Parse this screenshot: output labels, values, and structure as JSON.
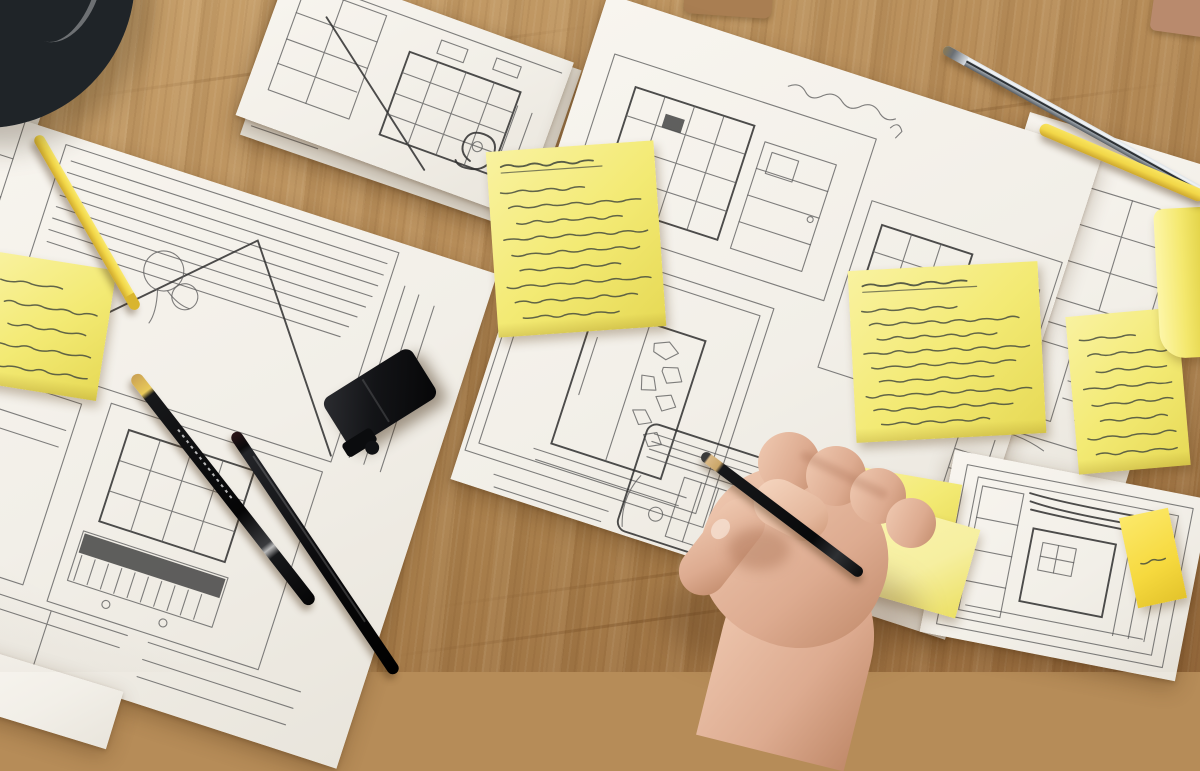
{
  "image_type": "photograph",
  "scene_description": "Top-down photo of a designer's wooden desk covered with overlapping paper sheets of hand-drawn pencil wireframe / interior sketches, yellow sticky notes with illegible handwritten annotations, yellow pencils, black pens, a chrome pen, a dark drinking glass, a black clip, and a hand holding a pencil while sketching",
  "colors": {
    "wood_base": "#b68c58",
    "wood_light": "#c9a26d",
    "wood_dark": "#95693c",
    "paper": "#f2efe8",
    "paper_under": "#e7e3d9",
    "sticky": "#f3ea74",
    "sticky_bright": "#f9f2a0",
    "sticky_deep": "#e6d955",
    "sticky_gold": "#f6d93e",
    "ink": "#474c3e",
    "graphite": "#5c5c5c",
    "graphite_dark": "#2e2e2e",
    "pen_black": "#17181a",
    "pen_yellow": "#f2d748",
    "chrome_light": "#dde2e6",
    "chrome_dark": "#565c62",
    "skin": "#f0cab2",
    "skin_mid": "#ddab90",
    "skin_shadow": "#c18a6a",
    "glass_dark": "#1f2428",
    "glass_rim": "#9aa5ad"
  },
  "papers": [
    {
      "id": "corner-sheet-under-glass",
      "description": "white sheet corner under the glass, top-left"
    },
    {
      "id": "left-sheet",
      "description": "large tilted sheet with storyboard wireframes: blinds, triangle, window grids, zigzag skyline"
    },
    {
      "id": "stacked-sheets-top",
      "description": "small stack of sheets with interior perspective sketch (shelf, window, spiral lamp)"
    },
    {
      "id": "center-sheet",
      "description": "large sheet with room/appliance wireframe panels, annotated"
    },
    {
      "id": "right-column-sheet",
      "description": "sheet with two stacked wireframe panels under the yellow pencil"
    },
    {
      "id": "bottom-right-sheet",
      "description": "sheet with dense nested-rectangle wireframe sketch"
    }
  ],
  "sticky_notes": [
    {
      "id": "task-list-note",
      "description": "large note with underlined title and bulleted handwritten list",
      "handwriting": "illegible",
      "scribble_lines": 9,
      "has_title_line": true
    },
    {
      "id": "left-edge-note",
      "description": "note partly cut by left edge",
      "handwriting": "illegible",
      "scribble_lines": 5,
      "has_title_line": false
    },
    {
      "id": "annotations-note-large",
      "description": "large note with dense handwritten annotations",
      "handwriting": "illegible",
      "scribble_lines": 9,
      "has_title_line": true
    },
    {
      "id": "annotations-note-right",
      "description": "note with handwritten annotations near right side",
      "handwriting": "illegible",
      "scribble_lines": 8,
      "has_title_line": false
    },
    {
      "id": "curled-note-right-edge",
      "description": "curled note at right edge",
      "handwriting": "none",
      "scribble_lines": 0,
      "has_title_line": false
    },
    {
      "id": "note-under-hand-top",
      "description": "note partly hidden by the hand",
      "handwriting": "illegible",
      "scribble_lines": 3,
      "has_title_line": false
    },
    {
      "id": "note-under-hand-bottom",
      "description": "second note under the hand",
      "handwriting": "none",
      "scribble_lines": 0,
      "has_title_line": false
    },
    {
      "id": "index-tab-note",
      "description": "small bright index tab with tiny mark",
      "handwriting": "illegible",
      "scribble_lines": 1,
      "has_title_line": false
    }
  ],
  "writing_tools": [
    {
      "id": "yellow-pencil-left",
      "type": "pencil",
      "color": "yellow"
    },
    {
      "id": "black-pencil-yellow-tip",
      "type": "pencil",
      "color": "black"
    },
    {
      "id": "black-fineliner",
      "type": "pen",
      "color": "black"
    },
    {
      "id": "pencil-in-hand",
      "type": "pencil",
      "color": "black, sharpened wood tip"
    },
    {
      "id": "chrome-pen",
      "type": "pen",
      "color": "silver chrome"
    },
    {
      "id": "yellow-pencil-top-right",
      "type": "pencil",
      "color": "yellow"
    }
  ],
  "objects": [
    {
      "id": "dark-glass",
      "description": "dark drinking glass, top-left corner"
    },
    {
      "id": "black-clip",
      "description": "black rectangular clip/eraser on left sheet"
    },
    {
      "id": "tan-folder-edge",
      "description": "tan object edge at top center"
    },
    {
      "id": "terracotta-strip",
      "description": "terracotta object sliver at top-right corner"
    }
  ],
  "hand": {
    "id": "right-hand",
    "description": "hand entering from bottom, gripping a pencil over the center sheet",
    "holding": "pencil-in-hand"
  }
}
